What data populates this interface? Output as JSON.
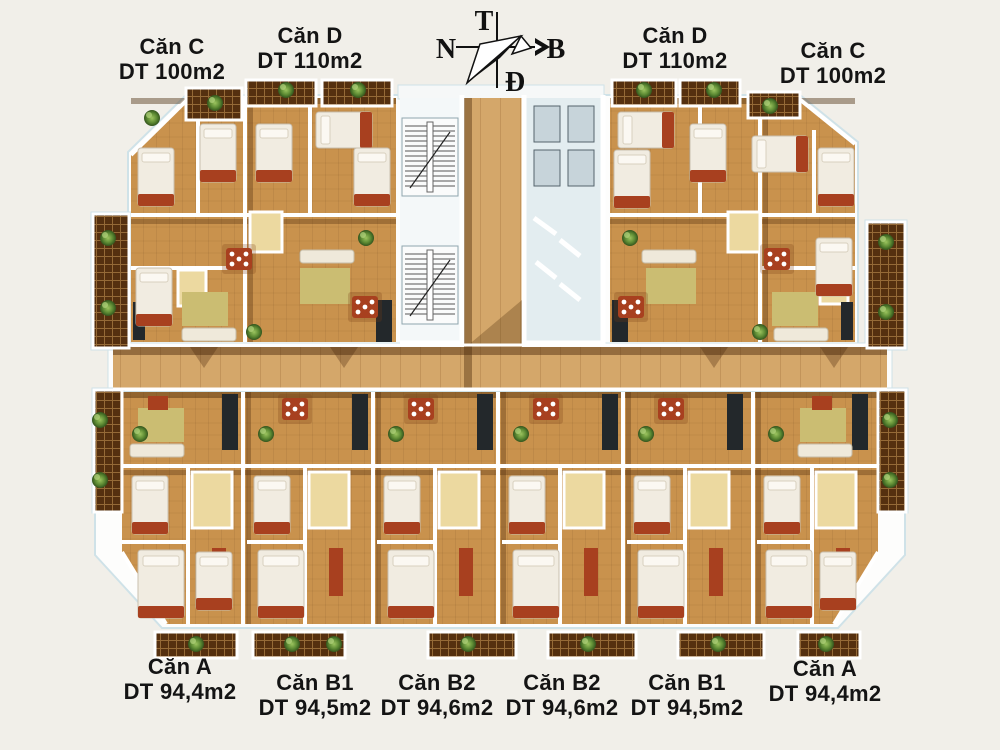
{
  "compass": {
    "top": "T",
    "left": "N",
    "right": "B",
    "bottom": "Đ"
  },
  "top_labels": [
    {
      "name": "Căn C",
      "area": "DT 100m2"
    },
    {
      "name": "Căn D",
      "area": "DT 110m2"
    },
    {
      "name": "Căn D",
      "area": "DT 110m2"
    },
    {
      "name": "Căn C",
      "area": "DT 100m2"
    }
  ],
  "bottom_labels": [
    {
      "name": "Căn A",
      "area": "DT 94,4m2"
    },
    {
      "name": "Căn B1",
      "area": "DT 94,5m2"
    },
    {
      "name": "Căn B2",
      "area": "DT 94,6m2"
    },
    {
      "name": "Căn B2",
      "area": "DT 94,6m2"
    },
    {
      "name": "Căn B1",
      "area": "DT 94,5m2"
    },
    {
      "name": "Căn A",
      "area": "DT 94,4m2"
    }
  ],
  "palette": {
    "bg": "#f1efe9",
    "wood": "#c9924d",
    "corridor": "#d4a76a",
    "tile": "#55300f",
    "wall": "#ffffff",
    "platform_edge": "#cfe2e8",
    "furniture_red": "#a8401f",
    "bed": "#f1ece1",
    "bath": "#ecd9a0",
    "kitchen": "#23282b",
    "label_text": "#141414",
    "compass_ink": "#111111"
  }
}
